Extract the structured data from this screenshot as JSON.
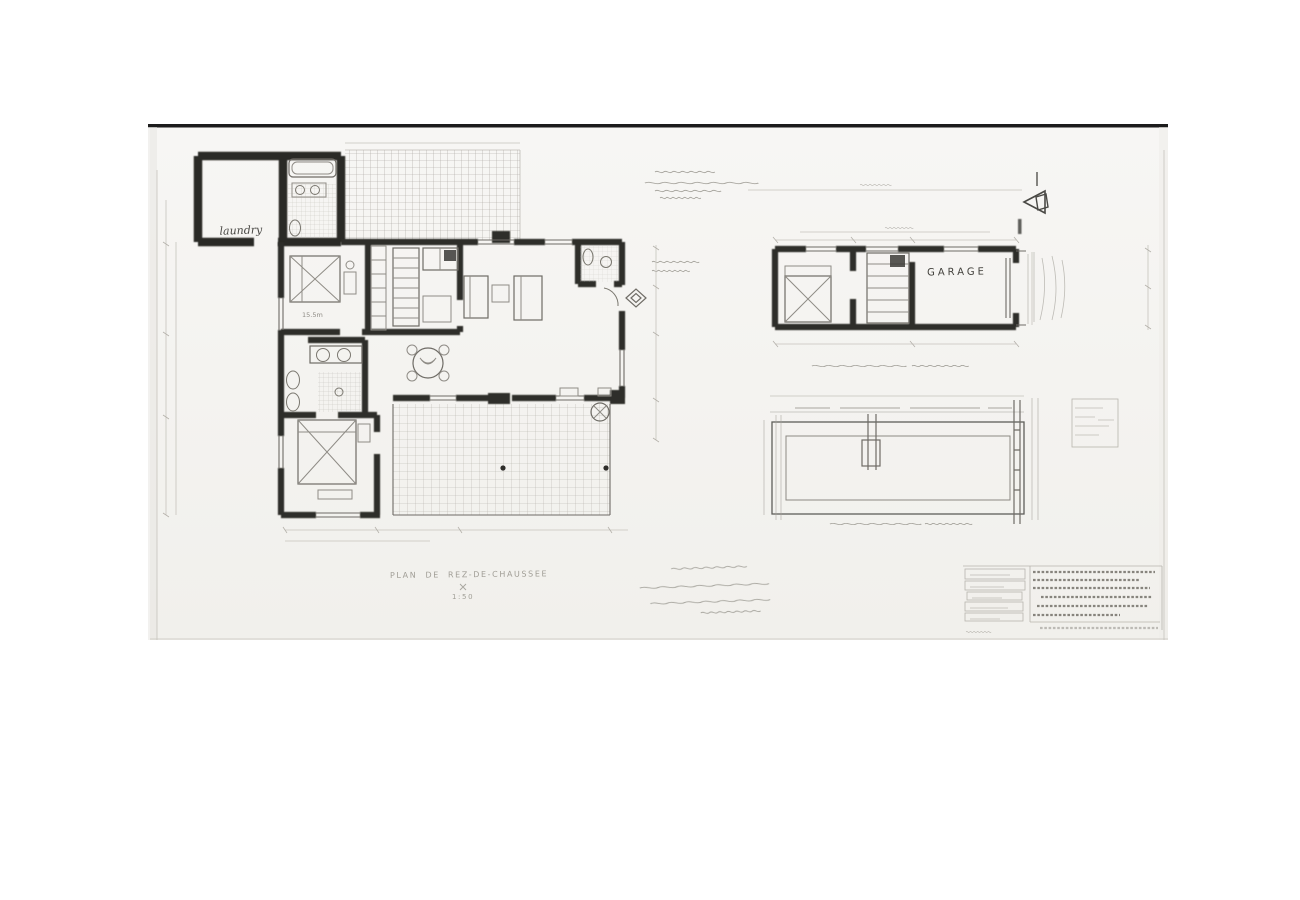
{
  "sheet": {
    "description": "scanned hand-drawn architectural ground-floor plan",
    "colors": {
      "paper": "#f5f4f2",
      "ink": "#2e2d2a",
      "faint_ink": "#8f8c84",
      "grid_line": "#b4b1aa",
      "top_edge": "#1c1c1c"
    }
  },
  "plan": {
    "labels": {
      "laundry": "laundry",
      "garage": "GARAGE",
      "bedroom_area": "15.5m"
    },
    "title": "PLAN DE REZ-DE-CHAUSSEE",
    "scale": "1:50"
  },
  "icons": {
    "north_arrow": "left-pointing hollow arrow"
  }
}
